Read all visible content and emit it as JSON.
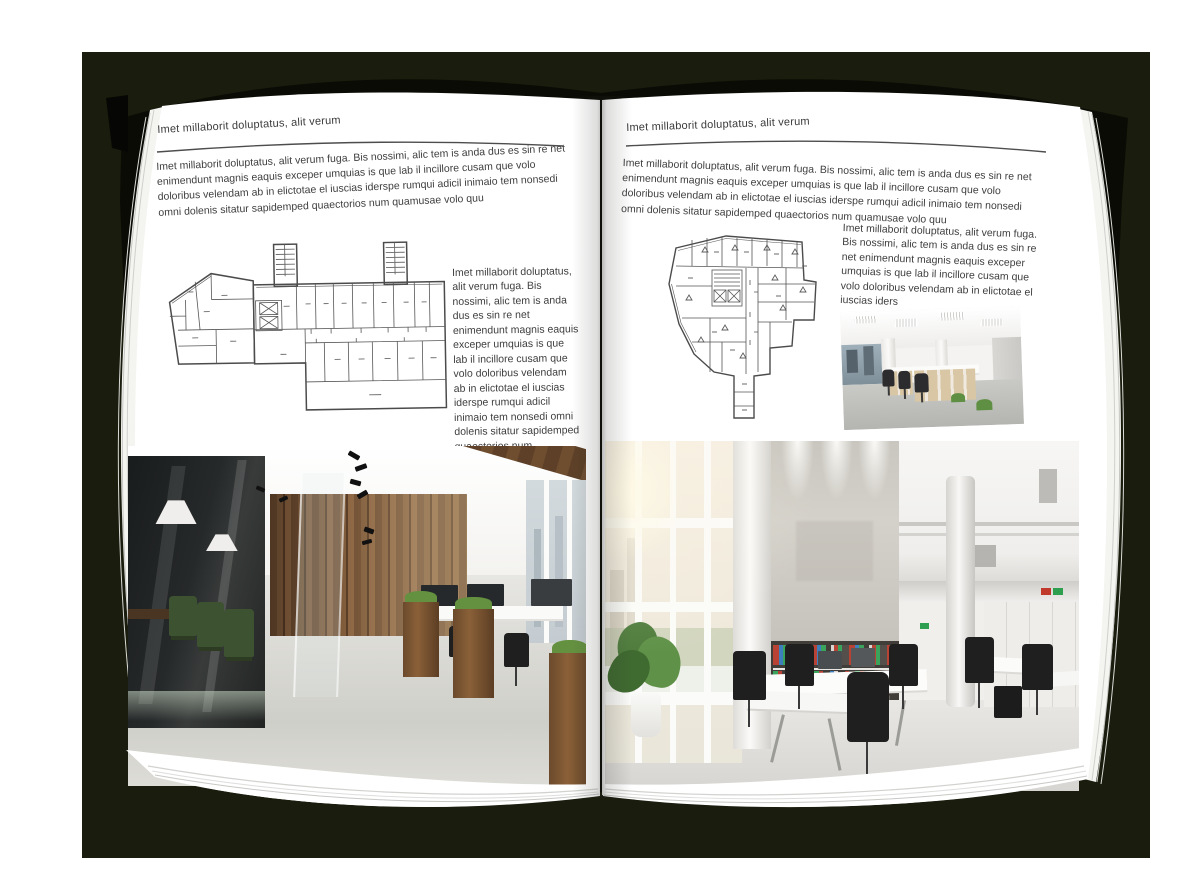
{
  "book": {
    "left_page": {
      "header": "Imet millaborit doluptatus, alit verum",
      "intro": "Imet millaborit doluptatus, alit verum fuga. Bis nossimi, alic tem is anda dus es sin re net enimendunt magnis eaquis exceper umquias is que lab il incillore cusam que volo doloribus velendam ab in elictotae el iuscias iderspe rumqui adicil inimaio tem nonsedi omni dolenis sitatur sapidemped quaectorios num quamusae volo quu",
      "side_text": "Imet millaborit doluptatus, alit verum fuga. Bis nossimi, alic tem is anda dus es sin re net enimendunt magnis eaquis exceper umquias is que lab il incillore cusam que volo doloribus velendam ab in elictotae el iuscias iderspe rumqui adicil inimaio tem nonsedi omni dolenis sitatur sapidemped quaectorios num quamusae volo quu"
    },
    "right_page": {
      "header": "Imet millaborit doluptatus, alit verum",
      "intro": "Imet millaborit doluptatus, alit verum fuga. Bis nossimi, alic tem is anda dus es sin re net enimendunt magnis eaquis exceper umquias is que lab il incillore cusam que volo doloribus velendam ab in elictotae el iuscias iderspe rumqui adicil inimaio tem nonsedi omni dolenis sitatur sapidemped quaectorios num quamusae volo quu",
      "side_text": "Imet millaborit doluptatus, alit verum fuga. Bis nossimi, alic tem is anda dus es sin re net enimendunt magnis eaquis exceper umquias is que lab il incillore cusam que volo doloribus velendam ab in elictotae el iuscias iders"
    }
  },
  "colors": {
    "backdrop": "#1a1c0d",
    "cover": "#0a0b05",
    "page": "#ffffff",
    "body_text": "#3e3e3e",
    "plan_line": "#4b4b4b"
  },
  "figures": {
    "left_floor_plan": "floor-plan-drawing",
    "right_floor_plan": "floor-plan-drawing",
    "left_photo": "office-interior-photo",
    "right_small_photo": "office-interior-photo",
    "right_large_photo": "office-interior-photo"
  }
}
